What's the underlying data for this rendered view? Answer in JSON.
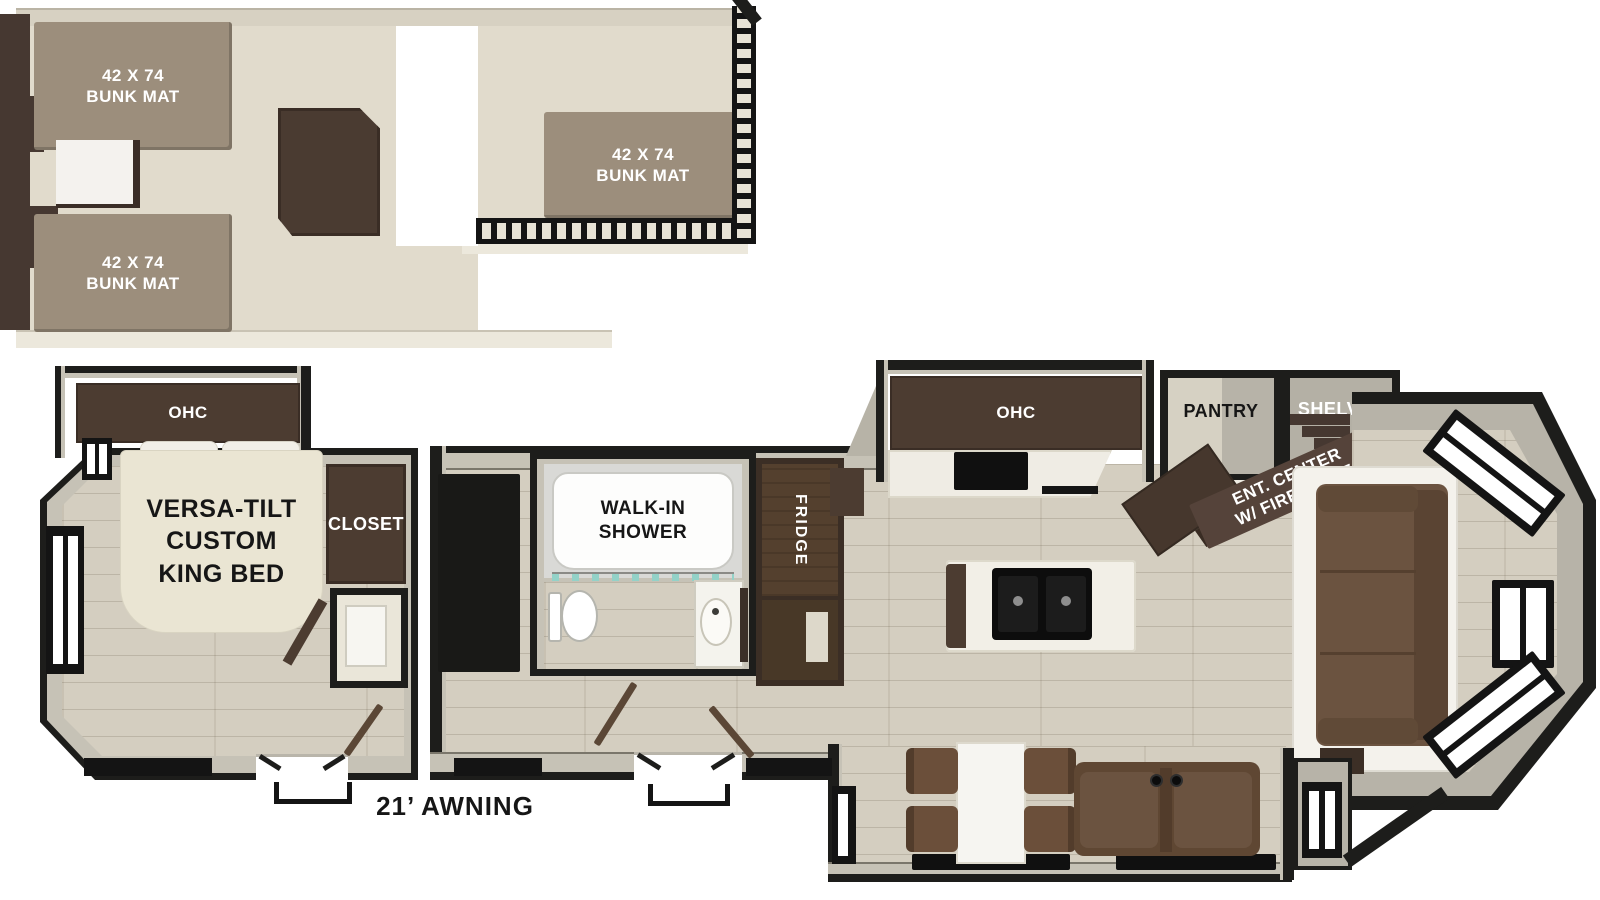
{
  "title": "Travel trailer floor plan with loft",
  "colors": {
    "floor_wood": "#d4cec0",
    "loft_floor": "#e1dbcc",
    "wall_gray": "#c6c2b6",
    "wall_dark": "#1d1d1b",
    "cabinet_dark": "#4c3c31",
    "bunk_mat": "#9c8e7c",
    "bed_cream": "#eae5d3",
    "sofa_brown": "#6b5340"
  },
  "loft": {
    "bunk_mats": [
      {
        "size": "42 X 74",
        "name": "BUNK MAT"
      },
      {
        "size": "42 X 74",
        "name": "BUNK MAT"
      },
      {
        "size": "42 X 74",
        "name": "BUNK MAT"
      }
    ]
  },
  "main": {
    "bedroom": {
      "ohc": "OHC",
      "bed_line1": "VERSA-TILT",
      "bed_line2": "CUSTOM",
      "bed_line3": "KING BED",
      "closet": "CLOSET"
    },
    "bath": {
      "shower_line1": "WALK-IN",
      "shower_line2": "SHOWER"
    },
    "kitchen": {
      "ohc": "OHC",
      "fridge": "FRIDGE",
      "pantry": "PANTRY"
    },
    "living": {
      "shelves": "SHELVES",
      "ent_line1": "ENT. CENTER",
      "ent_line2": "W/ FIREPLACE"
    },
    "awning": "21’ AWNING"
  }
}
